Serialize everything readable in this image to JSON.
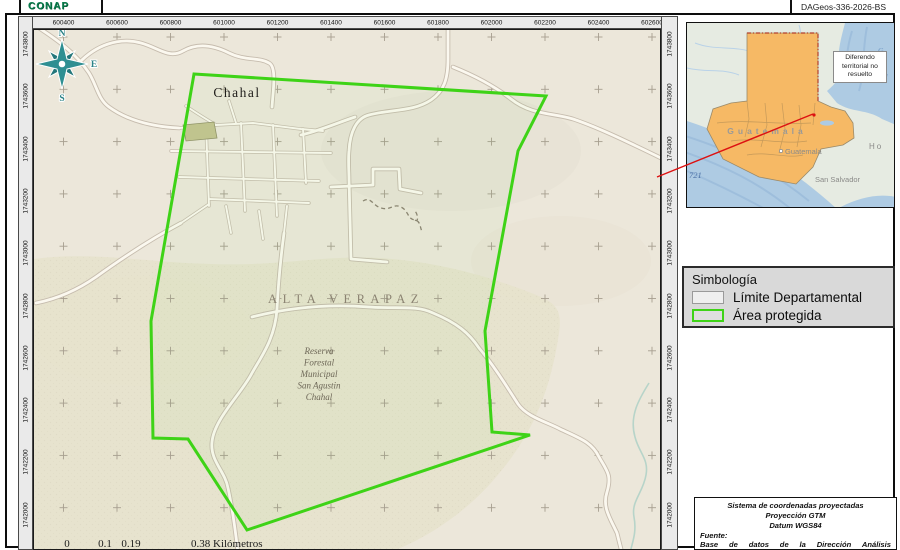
{
  "header": {
    "logo_text": "CONAP",
    "doc_code": "DAGeos-336-2026-BS"
  },
  "map": {
    "x_axis_labels": [
      "600400",
      "600600",
      "600800",
      "601000",
      "601200",
      "601400",
      "601600",
      "601800",
      "602000",
      "602200",
      "602400",
      "602600"
    ],
    "y_axis_labels": [
      "1743800",
      "1743600",
      "1743400",
      "1743200",
      "1743000",
      "1742800",
      "1742600",
      "1742400",
      "1742200",
      "1742000"
    ],
    "town_label": "Chahal",
    "department_label": "ALTA VERAPAZ",
    "reserve_label_lines": [
      "Reserva",
      "Forestal",
      "Municipal",
      "San Agustin",
      "Chahal"
    ],
    "compass": {
      "north": "N",
      "east": "E",
      "south": "S",
      "west": "O"
    },
    "scale_ticks": [
      "0",
      "0.1",
      "0.19",
      "0.38"
    ],
    "scale_unit": "Kilómetros"
  },
  "inset": {
    "country_label": "Guatemala",
    "capital_label": "Guatemala",
    "city_label": "San Salvador",
    "honduras_label_fragment": "Ho",
    "gulf_label_fragments": [
      "G",
      "Hond"
    ],
    "ref_number": "721",
    "note_lines": [
      "Diferendo",
      "territorial no",
      "resuelto"
    ]
  },
  "legend": {
    "title": "Simbología",
    "items": [
      {
        "label": "Límite Departamental",
        "swatch": "department-boundary"
      },
      {
        "label": "Área protegida",
        "swatch": "protected-area"
      }
    ]
  },
  "credits": {
    "title": "Sistema de coordenadas proyectadas",
    "projection": "Proyección GTM",
    "datum": "Datum WGS84",
    "source_label": "Fuente:",
    "source_text": "Base de datos de la Dirección Análisis Geoespacial"
  },
  "colors": {
    "protected_area_green": "#3ed317",
    "conap_green": "#0a7d4d",
    "guatemala_fill": "#f6b965",
    "ocean_blue": "#aecbe3",
    "paper_beige": "#ece7da",
    "callout_red": "#dd1111"
  }
}
